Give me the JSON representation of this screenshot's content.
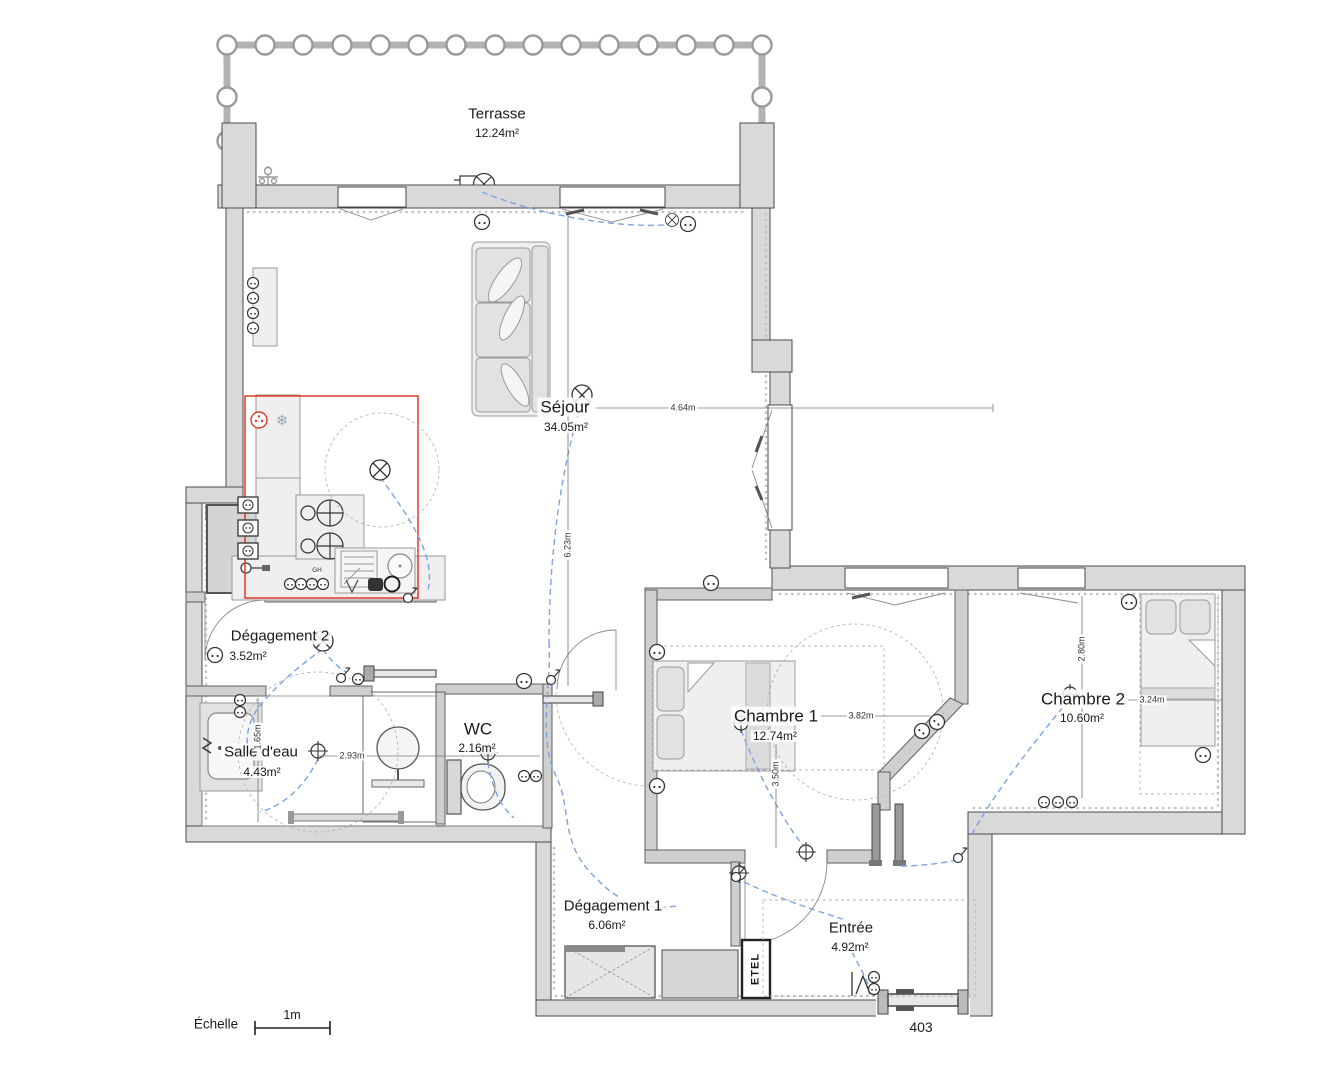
{
  "rooms": {
    "terrasse": {
      "name": "Terrasse",
      "area": "12.24m²"
    },
    "sejour": {
      "name": "Séjour",
      "area": "34.05m²"
    },
    "degagement2": {
      "name": "Dégagement 2",
      "area": "3.52m²"
    },
    "salle_deau": {
      "name": "Salle d'eau",
      "area": "4.43m²"
    },
    "wc": {
      "name": "WC",
      "area": "2.16m²"
    },
    "chambre1": {
      "name": "Chambre 1",
      "area": "12.74m²"
    },
    "chambre2": {
      "name": "Chambre 2",
      "area": "10.60m²"
    },
    "degagement1": {
      "name": "Dégagement 1",
      "area": "6.06m²"
    },
    "entree": {
      "name": "Entrée",
      "area": "4.92m²"
    }
  },
  "dimensions": {
    "sejour_width": "4.64m",
    "sejour_height": "6.23m",
    "salle_deau_height": "1.65m",
    "salle_deau_width": "2.93m",
    "chambre1_width": "3.82m",
    "chambre1_height": "3.50m",
    "chambre2_height": "2.80m",
    "chambre2_width": "3.24m"
  },
  "scale_bar": {
    "label": "Échelle",
    "length_label": "1m"
  },
  "door_number": "403",
  "technical": {
    "etel_label": "ETEL",
    "gh_label": "GH"
  },
  "icons": {
    "fridge_snowflake": "❄"
  },
  "colors": {
    "wall_fill": "#d9d9d9",
    "wall_stroke": "#4a4a4a",
    "kitchen_zone_outline": "#e0392b",
    "wiring_blue": "#7da3e0",
    "hatch_gray": "#cdcdcd"
  }
}
